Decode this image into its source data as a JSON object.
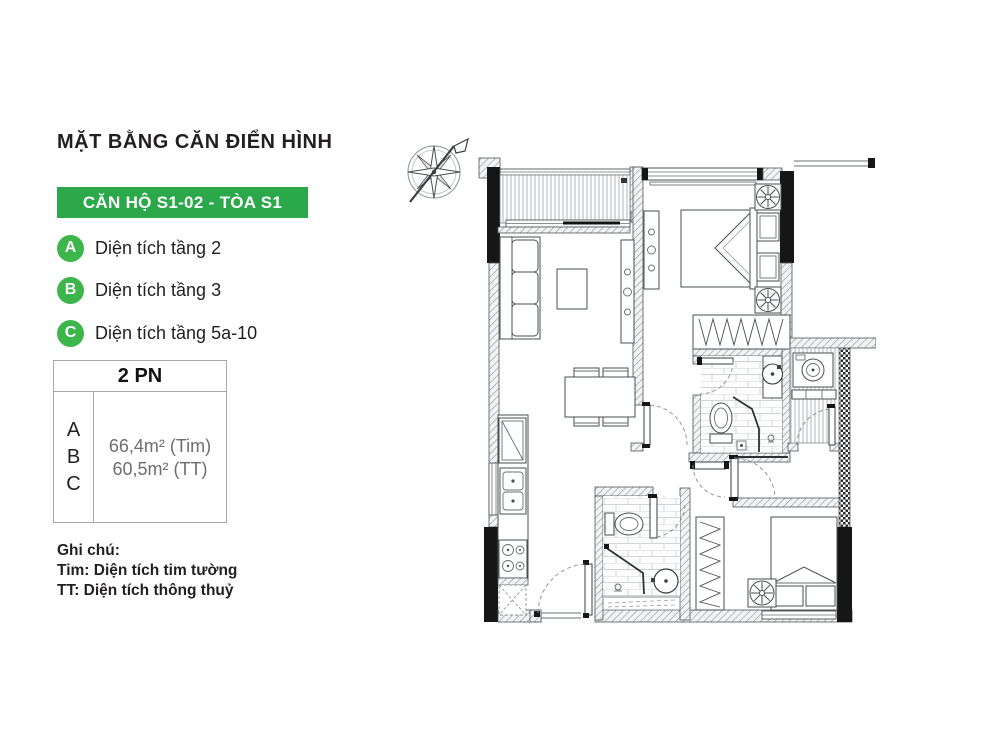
{
  "title": "MẶT BẰNG CĂN ĐIỂN HÌNH",
  "banner": {
    "label": "CĂN HỘ S1-02 - TÒA S1"
  },
  "legend": {
    "items": [
      {
        "key": "A",
        "label": "Diện tích tầng 2"
      },
      {
        "key": "B",
        "label": "Diện tích tầng 3"
      },
      {
        "key": "C",
        "label": "Diện tích tầng 5a-10"
      }
    ]
  },
  "area_table": {
    "header": "2 PN",
    "keys": [
      "A",
      "B",
      "C"
    ],
    "area_tim": "66,4m² (Tim)",
    "area_tt": "60,5m² (TT)"
  },
  "notes": {
    "heading": "Ghi chú:",
    "line1": "Tim: Diện tích tim tường",
    "line2": "TT: Diện tích thông thuỷ"
  },
  "colors": {
    "banner_green": "#2aa84a",
    "badge_green": "#3cb54a",
    "text_dark": "#231f20",
    "area_text_gray": "#6d6e71",
    "table_border": "#a7a9ac"
  },
  "icons": {
    "compass": "compass-rose-icon"
  },
  "floorplan": {
    "rooms": [
      "balcony",
      "living-room",
      "dining-area",
      "kitchen",
      "bedroom-1",
      "wardrobe",
      "bathroom-1",
      "utility-balcony",
      "corridor",
      "bathroom-2",
      "bedroom-2"
    ]
  }
}
